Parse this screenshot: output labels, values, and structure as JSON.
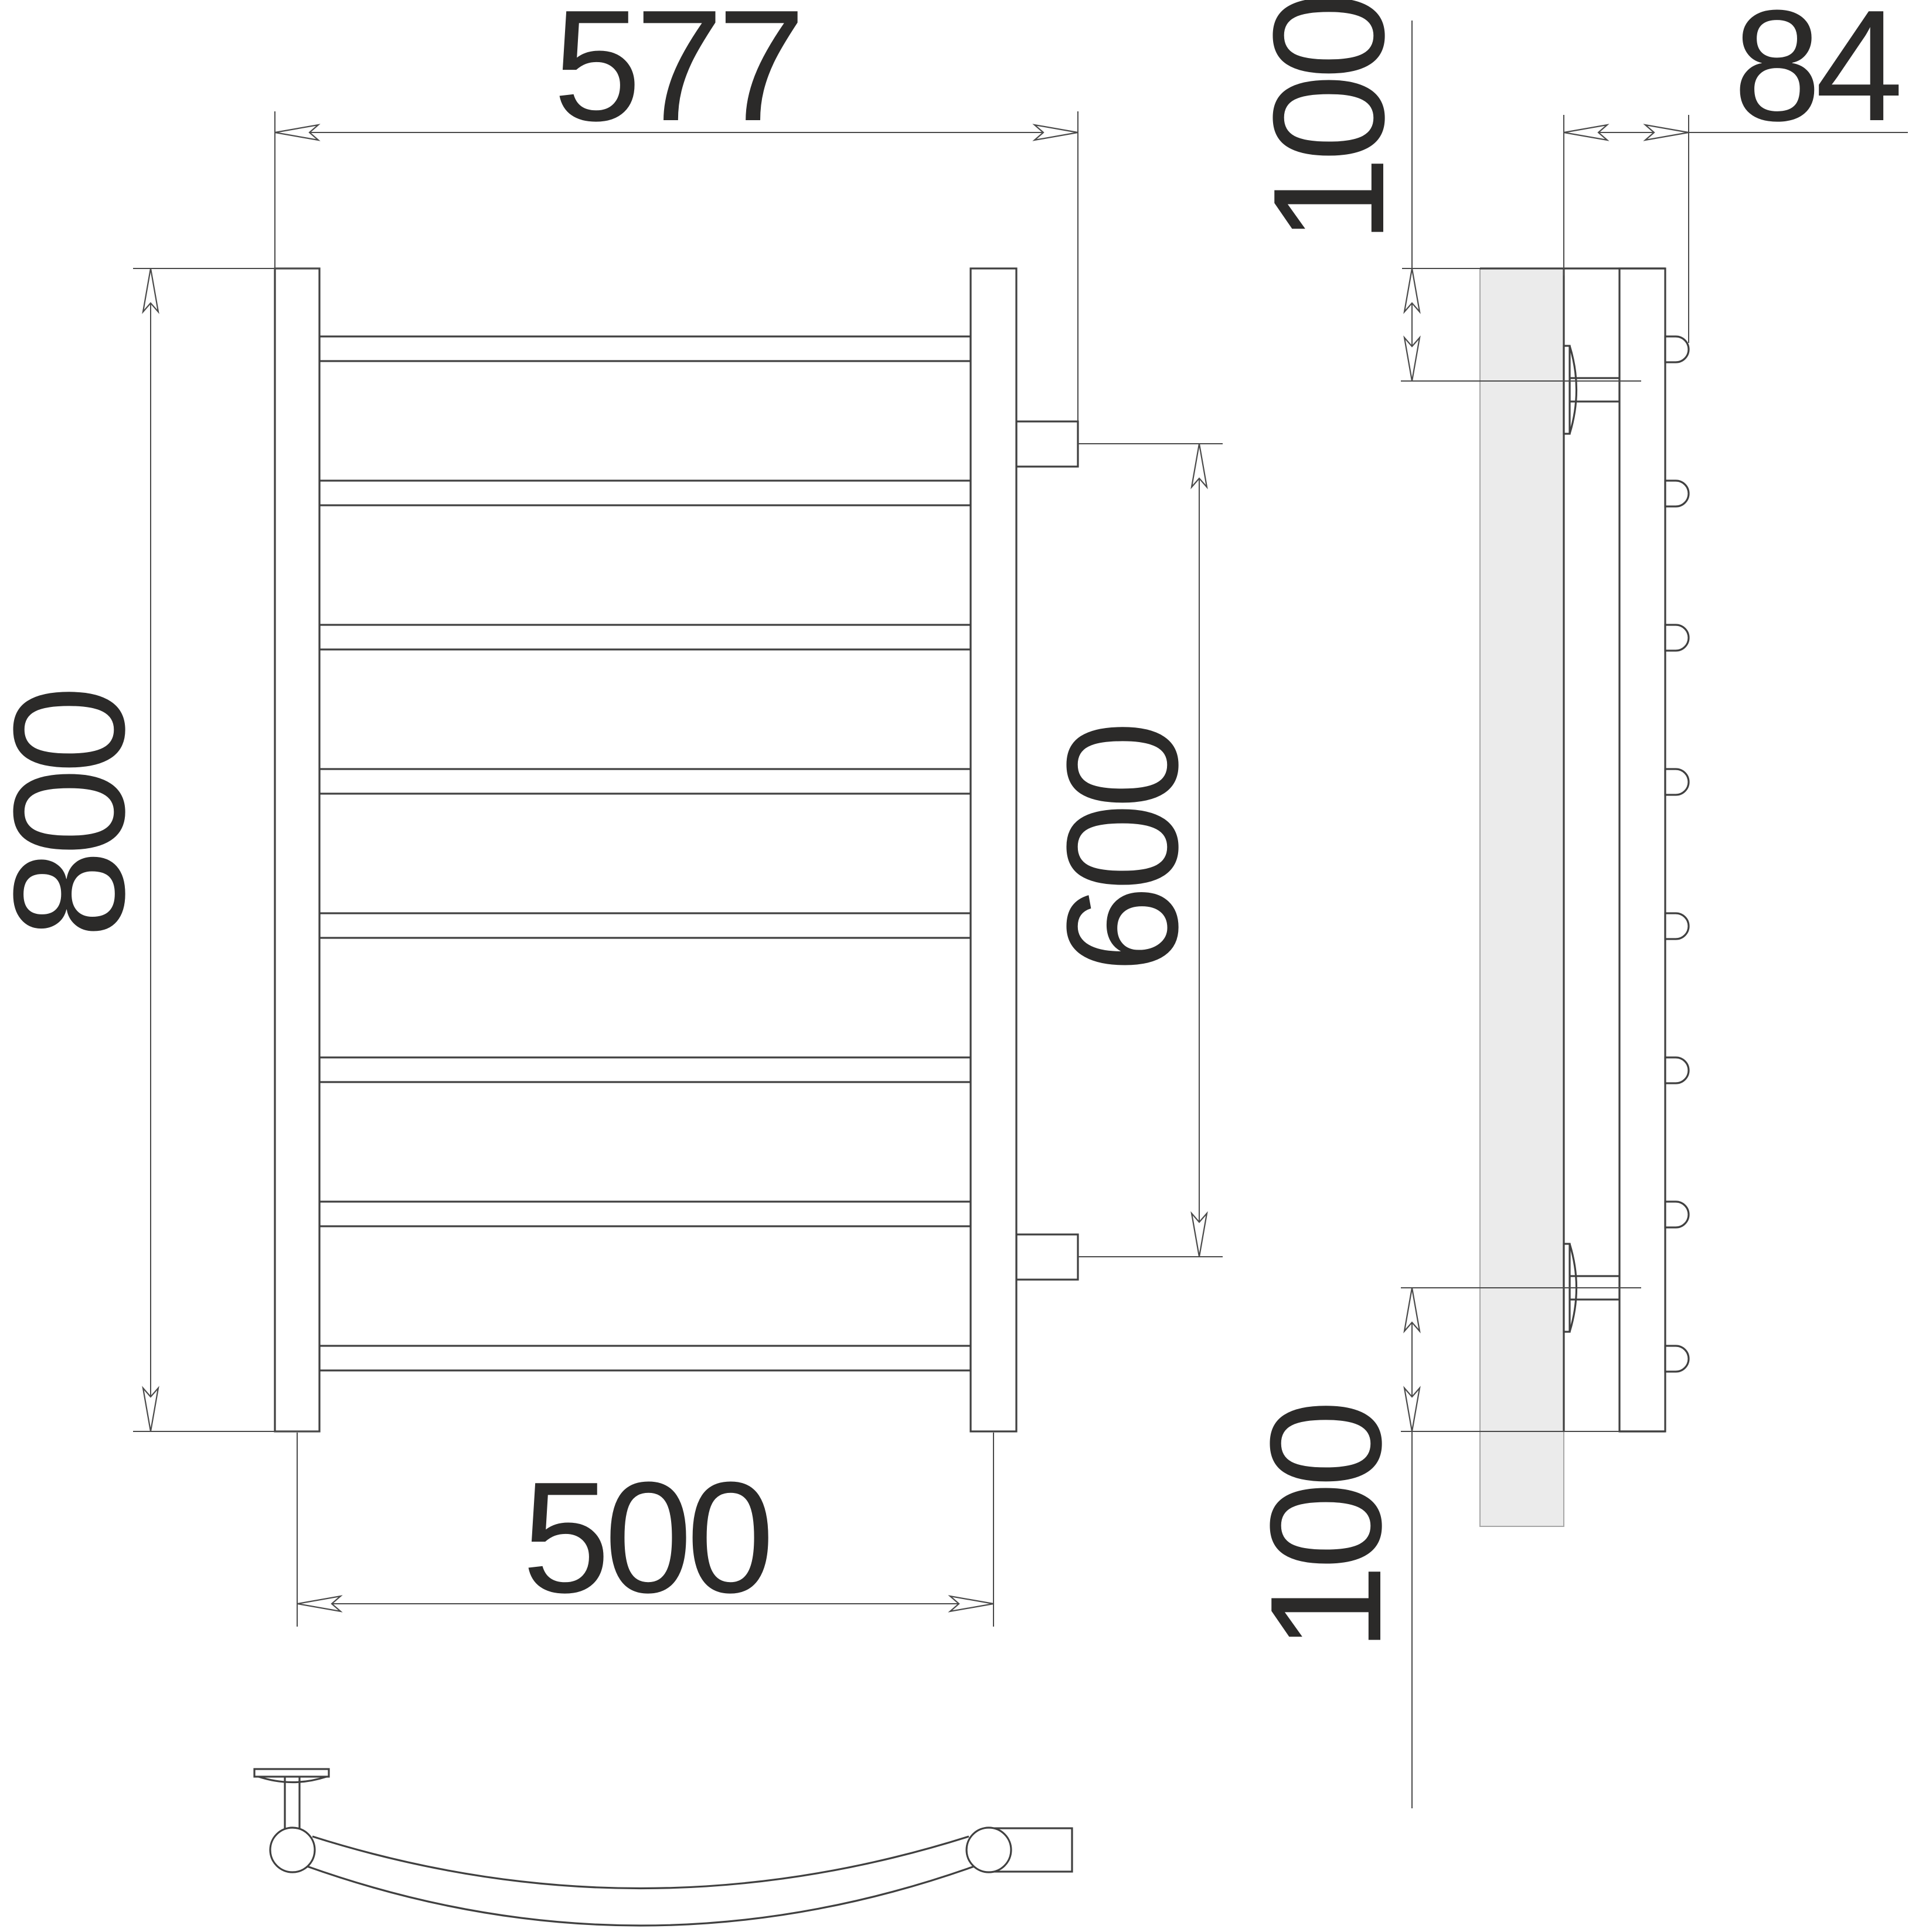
{
  "drawing": {
    "kind": "ladder-towel-rail-dimension-drawing",
    "rung_count": 8,
    "dimensions": {
      "overall_width": {
        "value": "577"
      },
      "overall_height": {
        "value": "800"
      },
      "mounting_width": {
        "value": "500"
      },
      "connection_height": {
        "value": "600"
      },
      "depth": {
        "value": "84"
      },
      "top_offset": {
        "value": "100"
      },
      "bottom_offset": {
        "value": "100"
      }
    },
    "colors": {
      "background": "#ffffff",
      "object_line": "#404040",
      "dimension_line": "#4a4a4a",
      "text": "#2b2a29",
      "wall_fill": "#ebebeb"
    }
  }
}
